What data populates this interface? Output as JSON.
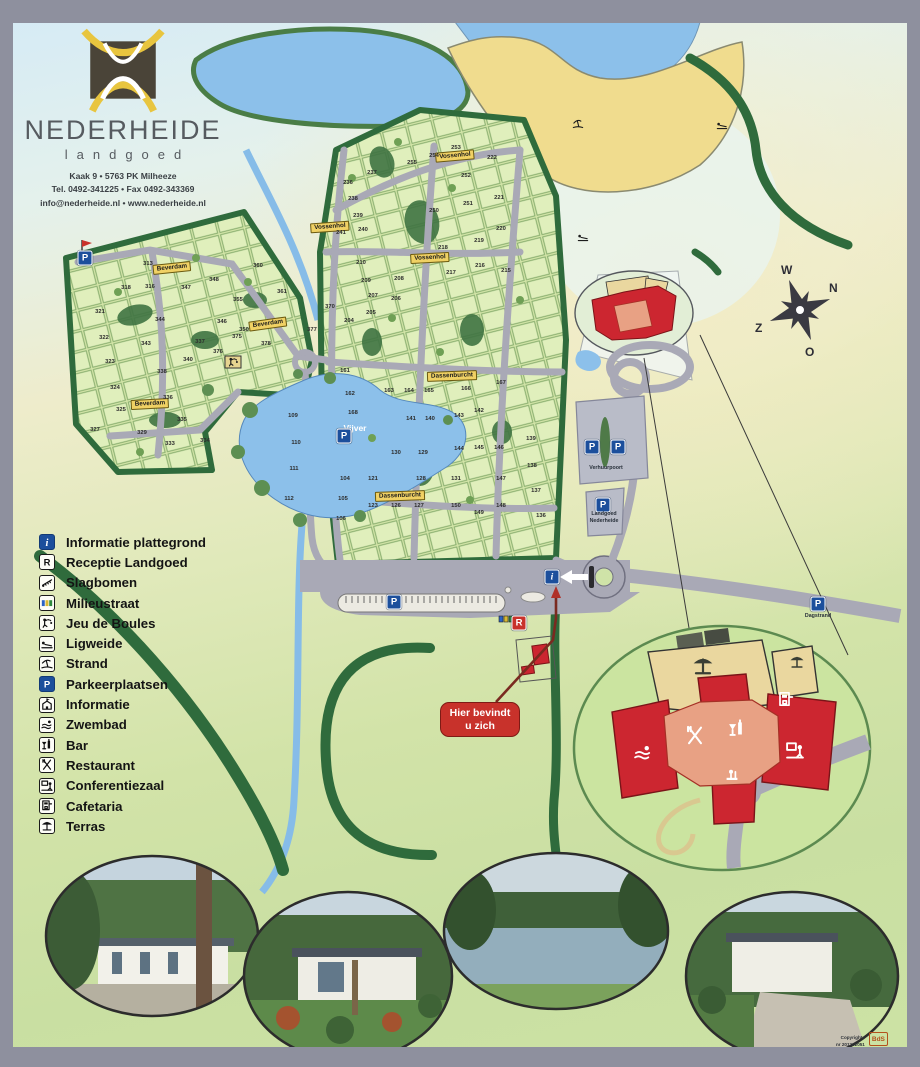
{
  "brand": {
    "title": "NEDERHEIDE",
    "subtitle": "landgoed",
    "address1": "Kaak 9  •  5763 PK Milheeze",
    "address2": "Tel. 0492-341225  •  Fax 0492-343369",
    "address3": "info@nederheide.nl  •  www.nederheide.nl"
  },
  "compass": {
    "n": "N",
    "e": "O",
    "s": "Z",
    "w": "W"
  },
  "legend": {
    "items": [
      {
        "icon": "info",
        "style": "blue",
        "label": "Informatie plattegrond"
      },
      {
        "icon": "r",
        "style": "box",
        "label": "Receptie Landgoed"
      },
      {
        "icon": "barrier",
        "style": "box",
        "label": "Slagbomen"
      },
      {
        "icon": "bins",
        "style": "box",
        "label": "Milieustraat"
      },
      {
        "icon": "boules",
        "style": "box",
        "label": "Jeu de Boules"
      },
      {
        "icon": "lounger",
        "style": "box",
        "label": "Ligweide"
      },
      {
        "icon": "strand",
        "style": "box",
        "label": "Strand"
      },
      {
        "icon": "p",
        "style": "blue",
        "label": "Parkeerplaatsen"
      },
      {
        "icon": "house",
        "style": "box",
        "label": "Informatie"
      },
      {
        "icon": "swim",
        "style": "box",
        "label": "Zwembad"
      },
      {
        "icon": "bar",
        "style": "box",
        "label": "Bar"
      },
      {
        "icon": "restaurant",
        "style": "box",
        "label": "Restaurant"
      },
      {
        "icon": "conference",
        "style": "box",
        "label": "Conferentiezaal"
      },
      {
        "icon": "cafetaria",
        "style": "box",
        "label": "Cafetaria"
      },
      {
        "icon": "terras",
        "style": "box",
        "label": "Terras"
      }
    ]
  },
  "map": {
    "water_label": "Vijver",
    "you_are_here": {
      "line1": "Hier bevindt",
      "line2": "u zich"
    },
    "road_labels": [
      {
        "text": "Beverdam",
        "x": 172,
        "y": 268,
        "rot": -6
      },
      {
        "text": "Beverdam",
        "x": 268,
        "y": 324,
        "rot": -8
      },
      {
        "text": "Beverdam",
        "x": 150,
        "y": 404,
        "rot": -3
      },
      {
        "text": "Vossenhol",
        "x": 455,
        "y": 156,
        "rot": -5
      },
      {
        "text": "Vossenhol",
        "x": 330,
        "y": 227,
        "rot": -4
      },
      {
        "text": "Vossenhol",
        "x": 430,
        "y": 258,
        "rot": -3
      },
      {
        "text": "Dassenburcht",
        "x": 452,
        "y": 376,
        "rot": -2
      },
      {
        "text": "Dassenburcht",
        "x": 400,
        "y": 496,
        "rot": -2
      }
    ],
    "parking_labels": [
      {
        "text": "Verhuurpoort",
        "x": 606,
        "y": 468
      },
      {
        "text": "Landgoed",
        "x": 604,
        "y": 514
      },
      {
        "text": "Nederheide",
        "x": 604,
        "y": 521
      },
      {
        "text": "Dagstrand",
        "x": 818,
        "y": 616
      }
    ],
    "badges": [
      {
        "t": "P",
        "x": 85,
        "y": 258
      },
      {
        "t": "P",
        "x": 344,
        "y": 436
      },
      {
        "t": "P",
        "x": 394,
        "y": 602
      },
      {
        "t": "P",
        "x": 592,
        "y": 447
      },
      {
        "t": "P",
        "x": 618,
        "y": 447
      },
      {
        "t": "P",
        "x": 603,
        "y": 505
      },
      {
        "t": "P",
        "x": 818,
        "y": 604
      },
      {
        "t": "i",
        "x": 552,
        "y": 577
      },
      {
        "t": "R",
        "x": 519,
        "y": 623
      }
    ],
    "icons": [
      {
        "icon": "lounger",
        "x": 722,
        "y": 125
      },
      {
        "icon": "lounger",
        "x": 583,
        "y": 237
      },
      {
        "icon": "strand",
        "x": 578,
        "y": 124
      },
      {
        "icon": "boules",
        "x": 233,
        "y": 362
      }
    ],
    "plot_numbers": [
      [
        313,
        148,
        264
      ],
      [
        316,
        150,
        287
      ],
      [
        318,
        126,
        288
      ],
      [
        321,
        100,
        312
      ],
      [
        322,
        104,
        338
      ],
      [
        323,
        110,
        362
      ],
      [
        324,
        115,
        388
      ],
      [
        325,
        121,
        410
      ],
      [
        327,
        95,
        430
      ],
      [
        329,
        142,
        433
      ],
      [
        333,
        170,
        444
      ],
      [
        334,
        205,
        441
      ],
      [
        335,
        182,
        420
      ],
      [
        336,
        168,
        398
      ],
      [
        337,
        200,
        342
      ],
      [
        338,
        162,
        372
      ],
      [
        340,
        188,
        360
      ],
      [
        343,
        146,
        344
      ],
      [
        344,
        160,
        320
      ],
      [
        346,
        222,
        322
      ],
      [
        347,
        186,
        288
      ],
      [
        348,
        214,
        280
      ],
      [
        350,
        244,
        330
      ],
      [
        355,
        238,
        300
      ],
      [
        360,
        258,
        266
      ],
      [
        361,
        282,
        292
      ],
      [
        370,
        330,
        307
      ],
      [
        375,
        237,
        337
      ],
      [
        376,
        218,
        352
      ],
      [
        377,
        312,
        330
      ],
      [
        378,
        266,
        344
      ],
      [
        253,
        456,
        148
      ],
      [
        254,
        434,
        156
      ],
      [
        255,
        412,
        163
      ],
      [
        252,
        466,
        176
      ],
      [
        251,
        468,
        204
      ],
      [
        250,
        434,
        211
      ],
      [
        237,
        372,
        173
      ],
      [
        236,
        348,
        183
      ],
      [
        238,
        353,
        199
      ],
      [
        239,
        358,
        216
      ],
      [
        240,
        363,
        230
      ],
      [
        241,
        341,
        233
      ],
      [
        222,
        492,
        158
      ],
      [
        221,
        499,
        198
      ],
      [
        220,
        501,
        229
      ],
      [
        219,
        479,
        241
      ],
      [
        218,
        443,
        248
      ],
      [
        217,
        451,
        273
      ],
      [
        216,
        480,
        266
      ],
      [
        215,
        506,
        271
      ],
      [
        210,
        361,
        263
      ],
      [
        209,
        366,
        281
      ],
      [
        208,
        399,
        279
      ],
      [
        207,
        373,
        296
      ],
      [
        206,
        396,
        299
      ],
      [
        205,
        371,
        313
      ],
      [
        204,
        349,
        321
      ],
      [
        161,
        345,
        371
      ],
      [
        162,
        350,
        394
      ],
      [
        163,
        389,
        391
      ],
      [
        164,
        409,
        391
      ],
      [
        165,
        429,
        391
      ],
      [
        166,
        466,
        389
      ],
      [
        167,
        501,
        383
      ],
      [
        168,
        353,
        413
      ],
      [
        142,
        479,
        411
      ],
      [
        143,
        459,
        416
      ],
      [
        141,
        411,
        419
      ],
      [
        140,
        430,
        419
      ],
      [
        139,
        531,
        439
      ],
      [
        144,
        459,
        449
      ],
      [
        145,
        479,
        448
      ],
      [
        146,
        499,
        448
      ],
      [
        147,
        501,
        479
      ],
      [
        131,
        456,
        479
      ],
      [
        130,
        396,
        453
      ],
      [
        129,
        423,
        453
      ],
      [
        128,
        421,
        479
      ],
      [
        121,
        373,
        479
      ],
      [
        123,
        373,
        506
      ],
      [
        126,
        396,
        506
      ],
      [
        127,
        419,
        506
      ],
      [
        150,
        456,
        506
      ],
      [
        149,
        479,
        513
      ],
      [
        148,
        501,
        506
      ],
      [
        138,
        532,
        466
      ],
      [
        137,
        536,
        491
      ],
      [
        136,
        541,
        516
      ],
      [
        104,
        345,
        479
      ],
      [
        105,
        343,
        499
      ],
      [
        106,
        341,
        519
      ],
      [
        109,
        293,
        416
      ],
      [
        110,
        296,
        443
      ],
      [
        111,
        294,
        469
      ],
      [
        112,
        289,
        499
      ]
    ]
  },
  "inset": {
    "icons": [
      {
        "icon": "swim",
        "x": 643,
        "y": 753,
        "c": "#ffffff",
        "s": 22
      },
      {
        "icon": "restaurant",
        "x": 695,
        "y": 736,
        "c": "#ffffff",
        "s": 24
      },
      {
        "icon": "bar",
        "x": 737,
        "y": 729,
        "c": "#ffffff",
        "s": 22
      },
      {
        "icon": "cafetaria",
        "x": 786,
        "y": 700,
        "c": "#ffffff",
        "s": 20
      },
      {
        "icon": "conference",
        "x": 795,
        "y": 751,
        "c": "#ffffff",
        "s": 22
      },
      {
        "icon": "reception",
        "x": 733,
        "y": 777,
        "c": "#ffffff",
        "s": 20
      },
      {
        "icon": "terras",
        "x": 703,
        "y": 666,
        "c": "#3a3f35",
        "s": 26
      },
      {
        "icon": "terras",
        "x": 797,
        "y": 662,
        "c": "#3a3f35",
        "s": 18
      }
    ]
  },
  "copyright": {
    "line1": "Copyrights",
    "line2": "nr 201202051",
    "logo": "BdS",
    "logo_sub": "MEIJEL"
  },
  "colors": {
    "frame": "#8e909e",
    "water": "#8cc0ea",
    "sand": "#f0dc8e",
    "plot": "#dcecb4",
    "hedge": "#2f6b3c",
    "road": "#a9a9b6",
    "red": "#cc2630",
    "salmon": "#e8a184",
    "tan": "#ead79f",
    "badge_blue": "#1c4f9c",
    "label_yellow": "#f0d164"
  }
}
